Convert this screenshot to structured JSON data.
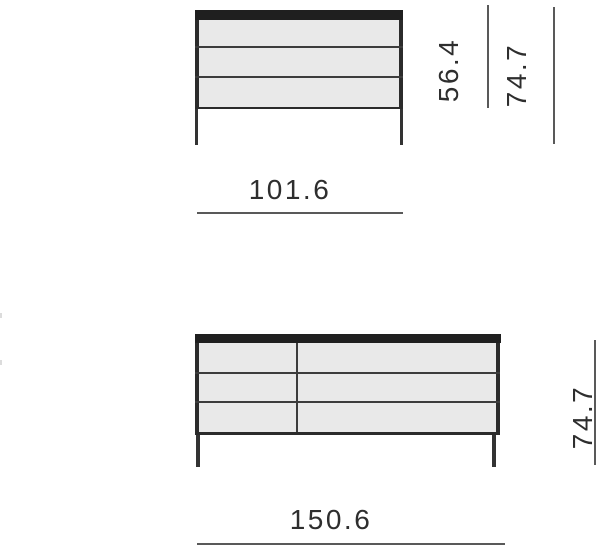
{
  "page": {
    "background": "#ffffff"
  },
  "colors": {
    "cabinet_top_panel": "#1f1f1f",
    "cabinet_outline": "#2b2b2b",
    "drawer_fill": "#e9e9e9",
    "drawer_divider": "#3c3c3c",
    "dimension_line": "#595959",
    "dimension_text": "#2e2e2e"
  },
  "drawings": [
    {
      "id": "sideboard-front-small",
      "drawer_rows": 3,
      "labels": {
        "width": "101.6",
        "body_height": "56.4",
        "total_height": "74.7"
      }
    },
    {
      "id": "sideboard-front-large",
      "drawer_rows": 3,
      "columns": 2,
      "labels": {
        "width": "150.6",
        "total_height": "74.7"
      }
    }
  ]
}
